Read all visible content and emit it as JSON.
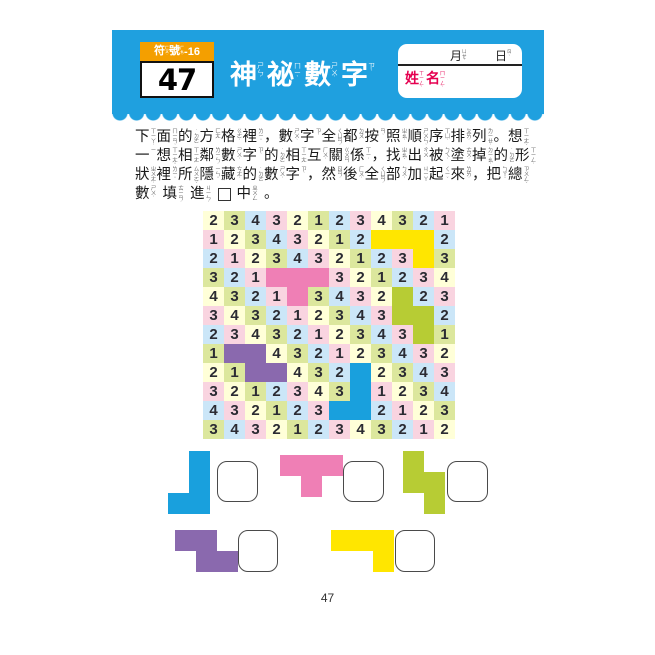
{
  "page": {
    "number": "47"
  },
  "header": {
    "band_color": "#1FA0DF",
    "badge": {
      "tab_color": "#F49F00",
      "tab_tokens": [
        {
          "c": "符",
          "z": "ㄈㄨˊ"
        },
        {
          "c": "號",
          "z": "ㄏㄠˋ"
        },
        {
          "c": "-16"
        }
      ],
      "number": "47"
    },
    "title_tokens": [
      {
        "c": "神",
        "z": "ㄕㄣˊ"
      },
      {
        "c": "祕",
        "z": "ㄇㄧˋ"
      },
      {
        "c": "數",
        "z": "ㄕㄨˋ"
      },
      {
        "c": "字",
        "z": "ㄗˋ"
      }
    ],
    "name_box": {
      "month_token": {
        "c": "月",
        "z": "ㄩㄝˋ"
      },
      "day_token": {
        "c": "日",
        "z": "ㄖˋ"
      },
      "name_tokens": [
        {
          "c": "姓",
          "z": "ㄒㄧㄥˋ"
        },
        {
          "c": "名",
          "z": "ㄇㄧㄥˊ"
        }
      ],
      "label_color": "#E50050"
    }
  },
  "instructions": {
    "lines": [
      [
        {
          "c": "下",
          "z": "ㄒㄧㄚˋ"
        },
        {
          "c": "面",
          "z": "ㄇㄧㄢˋ"
        },
        {
          "c": "的",
          "z": "˙ㄉㄜ"
        },
        {
          "c": "方",
          "z": "ㄈㄤ"
        },
        {
          "c": "格",
          "z": "ㄍㄜˊ"
        },
        {
          "c": "裡",
          "z": "ㄌㄧˇ"
        },
        {
          "c": "，"
        },
        {
          "c": "數",
          "z": "ㄕㄨˋ"
        },
        {
          "c": "字",
          "z": "ㄗˋ"
        },
        {
          "c": "全",
          "z": "ㄑㄩㄢˊ"
        },
        {
          "c": "都",
          "z": "ㄉㄡ"
        },
        {
          "c": "按",
          "z": "ㄢˋ"
        },
        {
          "c": "照",
          "z": "ㄓㄠˋ"
        },
        {
          "c": "順",
          "z": "ㄕㄨㄣˋ"
        },
        {
          "c": "序",
          "z": "ㄒㄩˋ"
        },
        {
          "c": "排",
          "z": "ㄆㄞˊ"
        },
        {
          "c": "列",
          "z": "ㄌㄧㄝˋ"
        },
        {
          "c": "。"
        },
        {
          "c": "想",
          "z": "ㄒㄧㄤˇ"
        }
      ],
      [
        {
          "c": "一",
          "z": "ㄧ"
        },
        {
          "c": "想",
          "z": "ㄒㄧㄤˇ"
        },
        {
          "c": "相",
          "z": "ㄒㄧㄤ"
        },
        {
          "c": "鄰",
          "z": "ㄌㄧㄣˊ"
        },
        {
          "c": "數",
          "z": "ㄕㄨˋ"
        },
        {
          "c": "字",
          "z": "ㄗˋ"
        },
        {
          "c": "的",
          "z": "˙ㄉㄜ"
        },
        {
          "c": "相",
          "z": "ㄒㄧㄤ"
        },
        {
          "c": "互",
          "z": "ㄏㄨˋ"
        },
        {
          "c": "關",
          "z": "ㄍㄨㄢ"
        },
        {
          "c": "係",
          "z": "ㄒㄧˋ"
        },
        {
          "c": "，"
        },
        {
          "c": "找",
          "z": "ㄓㄠˇ"
        },
        {
          "c": "出",
          "z": "ㄔㄨ"
        },
        {
          "c": "被",
          "z": "ㄅㄟˋ"
        },
        {
          "c": "塗",
          "z": "ㄊㄨˊ"
        },
        {
          "c": "掉",
          "z": "ㄉㄧㄠˋ"
        },
        {
          "c": "的",
          "z": "˙ㄉㄜ"
        },
        {
          "c": "形",
          "z": "ㄒㄧㄥˊ"
        }
      ],
      [
        {
          "c": "狀",
          "z": "ㄓㄨㄤˋ"
        },
        {
          "c": "裡",
          "z": "ㄌㄧˇ"
        },
        {
          "c": "所",
          "z": "ㄙㄨㄛˇ"
        },
        {
          "c": "隱",
          "z": "ㄧㄣˇ"
        },
        {
          "c": "藏",
          "z": "ㄘㄤˊ"
        },
        {
          "c": "的",
          "z": "˙ㄉㄜ"
        },
        {
          "c": "數",
          "z": "ㄕㄨˋ"
        },
        {
          "c": "字",
          "z": "ㄗˋ"
        },
        {
          "c": "，"
        },
        {
          "c": "然",
          "z": "ㄖㄢˊ"
        },
        {
          "c": "後",
          "z": "ㄏㄡˋ"
        },
        {
          "c": "全",
          "z": "ㄑㄩㄢˊ"
        },
        {
          "c": "部",
          "z": "ㄅㄨˋ"
        },
        {
          "c": "加",
          "z": "ㄐㄧㄚ"
        },
        {
          "c": "起",
          "z": "ㄑㄧˇ"
        },
        {
          "c": "來",
          "z": "ㄌㄞˊ"
        },
        {
          "c": "，"
        },
        {
          "c": "把",
          "z": "ㄅㄚˇ"
        },
        {
          "c": "總",
          "z": "ㄗㄨㄥˇ"
        }
      ],
      [
        {
          "c": "數",
          "z": "ㄕㄨˋ"
        },
        {
          "c": "填",
          "z": "ㄊㄧㄢˊ"
        },
        {
          "c": "進",
          "z": "ㄐㄧㄣˋ"
        },
        {
          "box": true
        },
        {
          "c": "中",
          "z": "ㄓㄨㄥ"
        },
        {
          "c": "。"
        }
      ]
    ]
  },
  "puzzle": {
    "grid": {
      "rows": 12,
      "cols": 12,
      "cell_palette": [
        "#FFFFD8",
        "#DCE79D",
        "#CBE6F8",
        "#F9D4E0"
      ],
      "number_color": "#2B2B33",
      "numbers": [
        [
          2,
          3,
          4,
          3,
          2,
          1,
          2,
          3,
          4,
          3,
          2,
          1
        ],
        [
          1,
          2,
          3,
          4,
          3,
          2,
          1,
          2,
          null,
          null,
          null,
          2
        ],
        [
          2,
          1,
          2,
          3,
          4,
          3,
          2,
          1,
          2,
          3,
          null,
          3
        ],
        [
          3,
          2,
          1,
          null,
          null,
          null,
          3,
          2,
          1,
          2,
          3,
          4
        ],
        [
          4,
          3,
          2,
          1,
          null,
          3,
          4,
          3,
          2,
          null,
          2,
          3
        ],
        [
          3,
          4,
          3,
          2,
          1,
          2,
          3,
          4,
          3,
          null,
          null,
          2
        ],
        [
          2,
          3,
          4,
          3,
          2,
          1,
          2,
          3,
          4,
          3,
          null,
          1
        ],
        [
          1,
          null,
          null,
          4,
          3,
          2,
          1,
          2,
          3,
          4,
          3,
          2
        ],
        [
          2,
          1,
          null,
          null,
          4,
          3,
          2,
          null,
          2,
          3,
          4,
          3
        ],
        [
          3,
          2,
          1,
          2,
          3,
          4,
          3,
          null,
          1,
          2,
          3,
          4
        ],
        [
          4,
          3,
          2,
          1,
          2,
          3,
          null,
          null,
          2,
          1,
          2,
          3
        ],
        [
          3,
          4,
          3,
          2,
          1,
          2,
          3,
          4,
          3,
          2,
          1,
          2
        ]
      ],
      "shapes": [
        {
          "name": "yellow-l",
          "color": "#FFE600",
          "cells": [
            [
              2,
              9
            ],
            [
              2,
              10
            ],
            [
              2,
              11
            ],
            [
              3,
              11
            ]
          ]
        },
        {
          "name": "pink-t",
          "color": "#EF7FB5",
          "cells": [
            [
              4,
              4
            ],
            [
              4,
              5
            ],
            [
              4,
              6
            ],
            [
              5,
              5
            ]
          ]
        },
        {
          "name": "green-s",
          "color": "#B7CC34",
          "cells": [
            [
              5,
              10
            ],
            [
              6,
              10
            ],
            [
              6,
              11
            ],
            [
              7,
              11
            ]
          ]
        },
        {
          "name": "purple-s",
          "color": "#8A69AE",
          "cells": [
            [
              8,
              2
            ],
            [
              8,
              3
            ],
            [
              9,
              3
            ],
            [
              9,
              4
            ]
          ]
        },
        {
          "name": "blue-j",
          "color": "#19A0DD",
          "cells": [
            [
              9,
              8
            ],
            [
              10,
              8
            ],
            [
              11,
              7
            ],
            [
              11,
              8
            ]
          ]
        }
      ]
    }
  },
  "answer_shapes": [
    {
      "name": "blue-j",
      "color": "#19A0DD",
      "cells": [
        [
          1,
          2
        ],
        [
          2,
          2
        ],
        [
          3,
          1
        ],
        [
          3,
          2
        ]
      ]
    },
    {
      "name": "pink-t",
      "color": "#EF7FB5",
      "cells": [
        [
          1,
          1
        ],
        [
          1,
          2
        ],
        [
          1,
          3
        ],
        [
          2,
          2
        ]
      ]
    },
    {
      "name": "green-s",
      "color": "#B7CC34",
      "cells": [
        [
          1,
          1
        ],
        [
          2,
          1
        ],
        [
          2,
          2
        ],
        [
          3,
          2
        ]
      ]
    },
    {
      "name": "purple-s",
      "color": "#8A69AE",
      "cells": [
        [
          1,
          1
        ],
        [
          1,
          2
        ],
        [
          2,
          2
        ],
        [
          2,
          3
        ]
      ]
    },
    {
      "name": "yellow-l",
      "color": "#FFE600",
      "cells": [
        [
          1,
          1
        ],
        [
          1,
          2
        ],
        [
          1,
          3
        ],
        [
          2,
          3
        ]
      ]
    }
  ]
}
